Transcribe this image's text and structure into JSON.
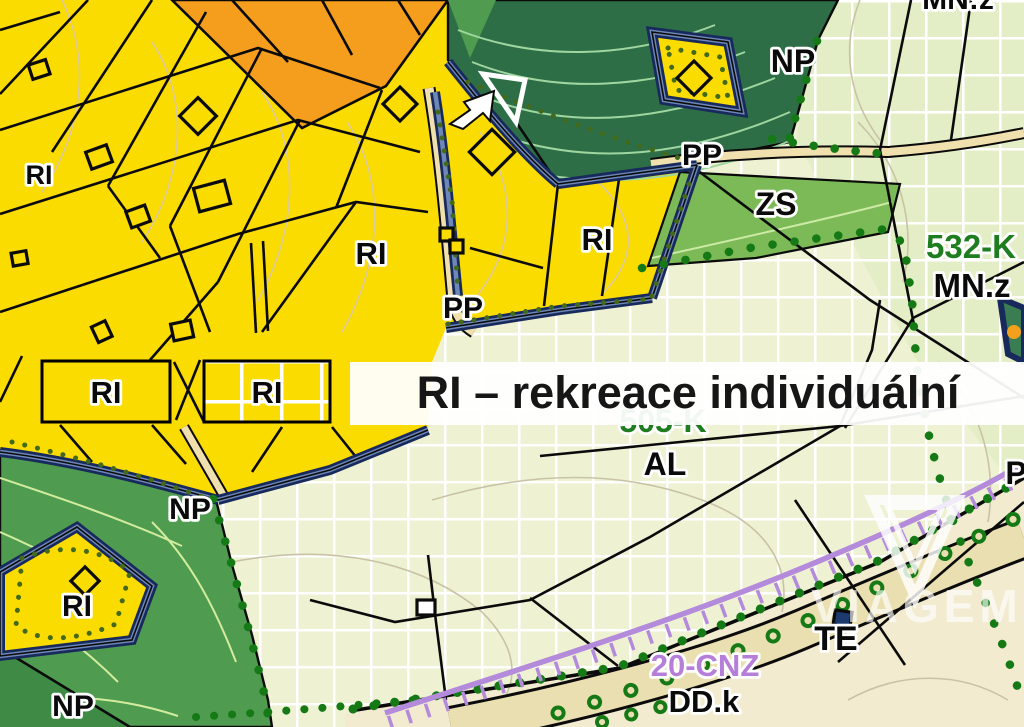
{
  "banner": {
    "title": "RI – rekreace individuální",
    "swatch_solid_label": "RI",
    "swatch_grid_label": "RI"
  },
  "labels": {
    "mn_z_top": "MN:z",
    "np_northeast": "NP",
    "pp_northeast": "PP",
    "zs": "ZS",
    "parcel_532k": "532-K",
    "mn_z_east": "MN.z",
    "ri_top_left": "RI",
    "ri_middle": "RI",
    "ri_center": "RI",
    "pp_center": "PP",
    "np_west": "NP",
    "ri_southwest": "RI",
    "np_southwest": "NP",
    "al": "AL",
    "parcel_505k": "505-K",
    "te": "TE",
    "dd_k": "DD.k",
    "cnz_20": "20-CNZ",
    "p_east": "P",
    "watermark": "VIAGEM"
  },
  "colors": {
    "zone_yellow": "#fbdc00",
    "zone_orange": "#f59e1d",
    "zone_dark_green": "#2d6e46",
    "zone_medium_green": "#4f9b4f",
    "zone_zs_green": "#7cba57",
    "pale_grid": "#eef2d3",
    "pale_grid_ne": "#e4eec6",
    "beige": "#f2ebd0",
    "road_tan": "#efe0ad",
    "border_navy": "#18295c",
    "border_steel_blue": "#6d87b6",
    "boundary_dot_green": "#157a15",
    "small_dot_olive": "#43691b",
    "railway_purple": "#b48bdb",
    "label_green": "#1e7d1e",
    "label_purple": "#b57fd9",
    "banner_white": "#ffffff"
  }
}
